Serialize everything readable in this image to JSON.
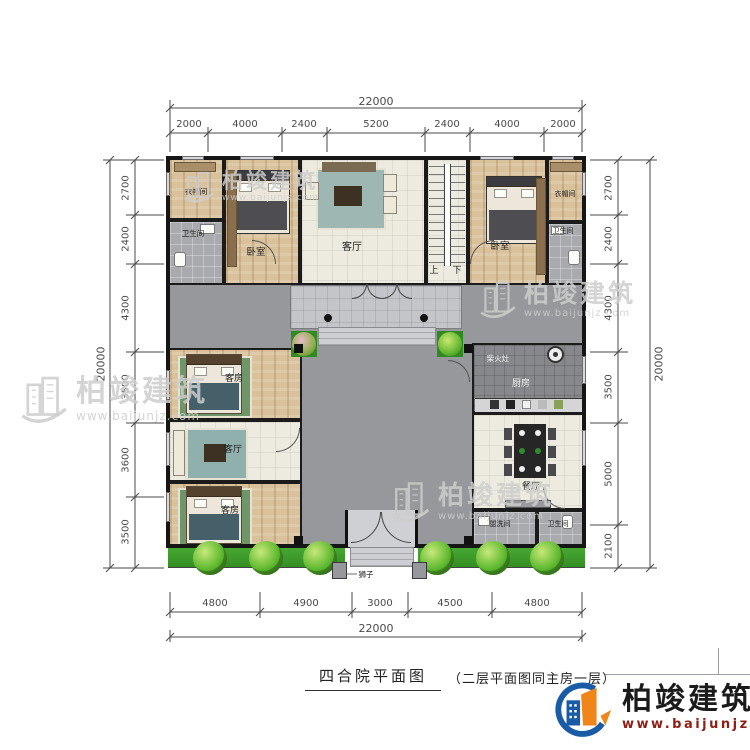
{
  "title": {
    "main": "四合院平面图",
    "note": "（二层平面图同主房一层）"
  },
  "brand": {
    "name": "柏竣建筑",
    "url": "www.baijunjz.com"
  },
  "colors": {
    "logo_blue": "#1a5ba6",
    "logo_orange": "#f08519",
    "url_red": "#8d1f15",
    "green_belt": "#3da32c",
    "wall": "#161616",
    "courtyard": "#96989c"
  },
  "dims": {
    "top": {
      "total": "22000",
      "segments": [
        "2000",
        "4000",
        "2400",
        "5200",
        "2400",
        "4000",
        "2000"
      ]
    },
    "bottom": {
      "total": "22000",
      "segments": [
        "4800",
        "4900",
        "3000",
        "4500",
        "4800"
      ]
    },
    "left": {
      "total": "20000",
      "segments": [
        "2700",
        "2400",
        "4300",
        "3500",
        "3600",
        "3500"
      ]
    },
    "right": {
      "total": "20000",
      "segments": [
        "2700",
        "2400",
        "4300",
        "3500",
        "5000",
        "2100"
      ]
    }
  },
  "rooms": {
    "cloak_tl": "衣帽间",
    "bath_tl": "卫生间",
    "bedroom_tl": "卧室",
    "living_top": "客厅",
    "stairs_up": "上",
    "stairs_down": "下",
    "bedroom_tr": "卧室",
    "cloak_tr": "衣帽间",
    "bath_tr": "卫生间",
    "guest_w1": "客房",
    "living_w": "客厅",
    "guest_w2": "客房",
    "kitchen": "厨房",
    "dining": "餐厅",
    "washroom": "盥洗间",
    "bath_br": "卫生间"
  },
  "annotations": {
    "stove": "柴火灶",
    "lion": "狮子"
  }
}
